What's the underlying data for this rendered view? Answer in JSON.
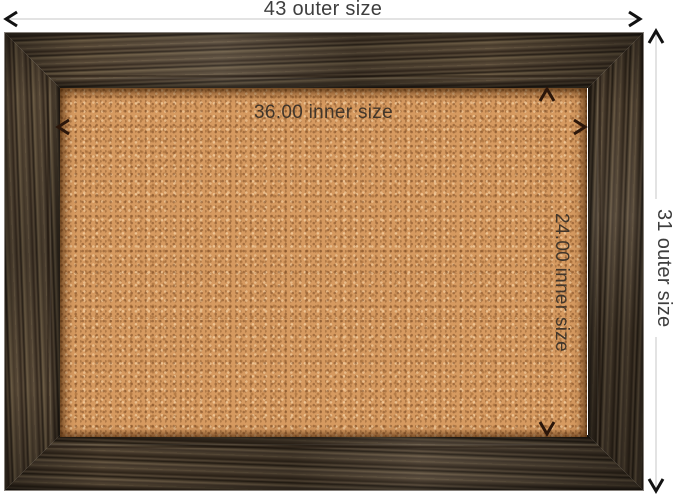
{
  "image": {
    "type": "product-dimension-diagram",
    "subject": "cork bulletin board with rustic barnwood frame",
    "background": "#ffffff"
  },
  "annotations": {
    "outer_width": {
      "label": "43 outer size",
      "value": 43
    },
    "outer_height": {
      "label": "31 outer size",
      "value": 31
    },
    "inner_width": {
      "label": "36.00 inner size",
      "value": 36.0
    },
    "inner_height": {
      "label": "24.00 inner size",
      "value": 24.0
    }
  },
  "colors": {
    "cork_base": "#d69a60",
    "cork_speck_dark": "#7a4a24",
    "cork_speck_light": "#f0cb9e",
    "frame_dark": "#2a2118",
    "frame_mid": "#5a4c3a",
    "frame_light": "#6e5e46",
    "outer_dim_line": "#c7c7c7",
    "outer_arrow": "#121212",
    "inner_dim_line": "#69381880",
    "inner_arrow": "#2b160a",
    "outer_label_text": "#3e3e3e",
    "inner_label_text": "#41362b"
  }
}
